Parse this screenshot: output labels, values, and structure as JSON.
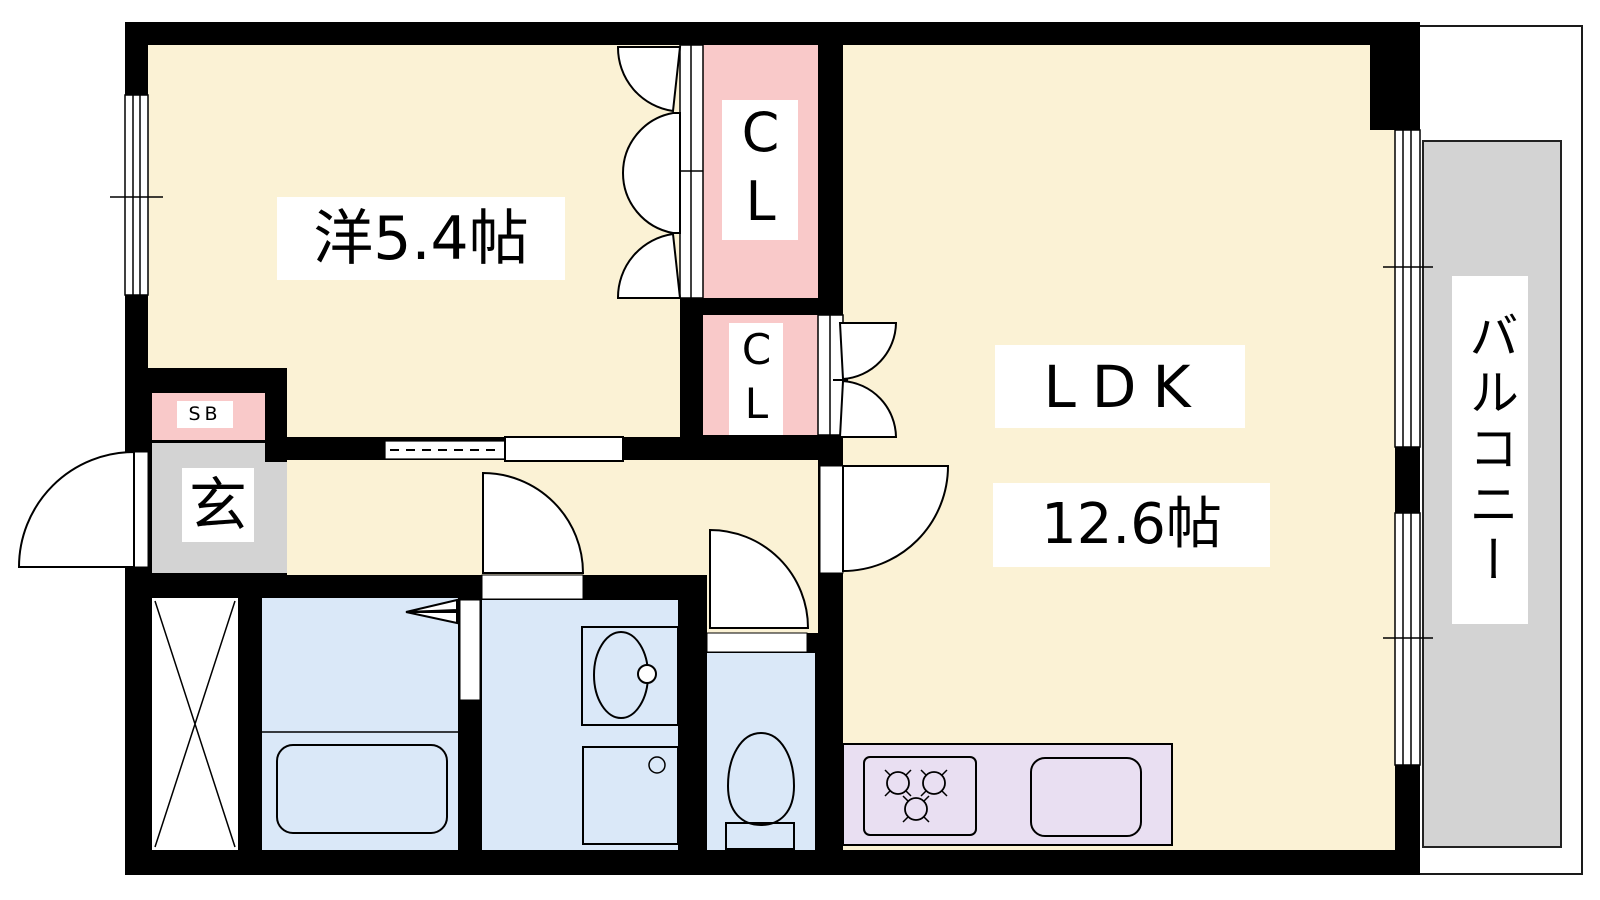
{
  "plan": {
    "type": "apartment-floor-plan",
    "rooms": {
      "bedroom": {
        "label": "洋5.4帖"
      },
      "closet_upper": {
        "label": "CL"
      },
      "closet_lower": {
        "label": "CL"
      },
      "ldk": {
        "label": "LDK",
        "area": "12.6帖"
      },
      "entrance": {
        "label": "玄"
      },
      "shoe_box": {
        "label": "SB"
      },
      "balcony": {
        "label": "バルコニー"
      }
    },
    "colors": {
      "wall": "#000000",
      "room_floor": "#FBF2D5",
      "closet_fill": "#F9C9C9",
      "entrance_floor": "#D3D3D3",
      "balcony_floor": "#D3D3D3",
      "wet_room_floor": "#DAE8F8",
      "kitchen_counter": "#E9DFF2",
      "label_background": "#FFFFFF"
    }
  }
}
